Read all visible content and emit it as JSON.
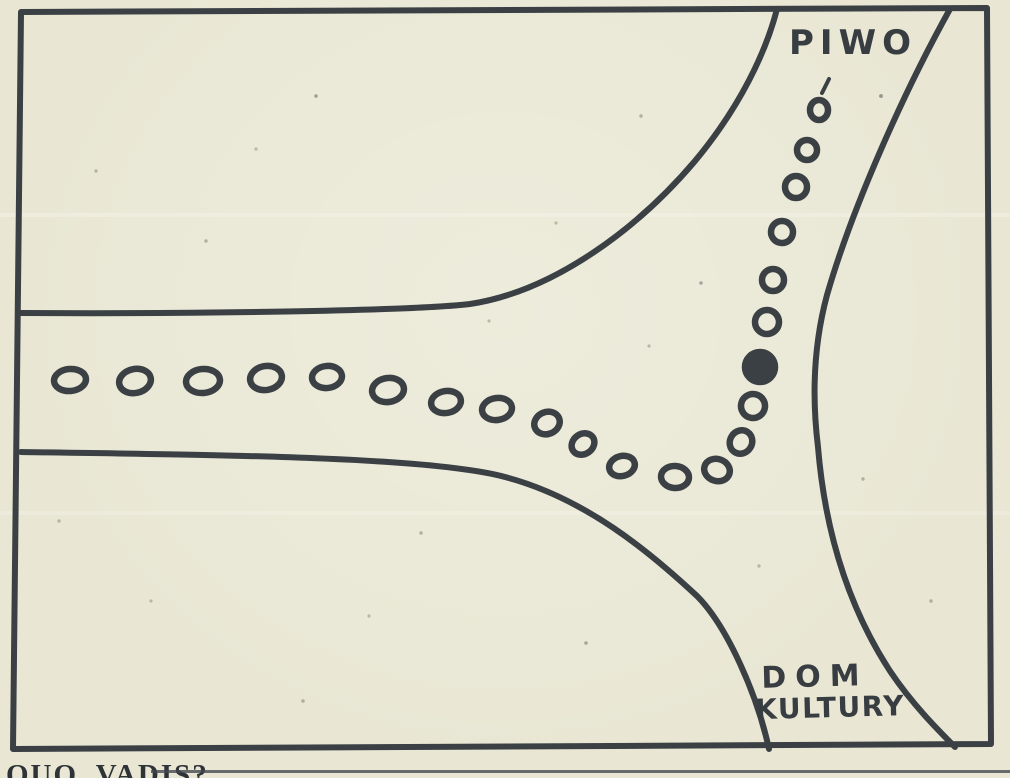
{
  "colors": {
    "paper": "#e9e7d4",
    "ink": "#3a4044"
  },
  "drawing": {
    "labels": {
      "piwo": "PIWO",
      "dom_line1": "DOM",
      "dom_line2": "KULTURY"
    },
    "roads": {
      "frame": "M 21 12 L 987 8 L 991 744 L 13 749 Z",
      "top_edge": "M 21 313 C 190 314 410 311 470 304 C 556 291 640 226 695 161 C 740 107 766 52 777 9",
      "bottom_edge": "M 21 452 C 230 455 430 457 505 477 C 585 498 650 552 697 596 C 727 626 757 694 769 749",
      "right_edge": "M 950 9 C 905 90 853 205 827 295 C 813 347 812 398 818 447 C 825 532 849 608 890 671 C 912 704 938 730 955 747"
    },
    "footprints": [
      {
        "cx": 70,
        "cy": 380,
        "rx": 16,
        "ry": 11,
        "rot": -5
      },
      {
        "cx": 135,
        "cy": 381,
        "rx": 16,
        "ry": 12,
        "rot": -12
      },
      {
        "cx": 203,
        "cy": 381,
        "rx": 17,
        "ry": 12,
        "rot": -5
      },
      {
        "cx": 266,
        "cy": 378,
        "rx": 16,
        "ry": 12,
        "rot": -10
      },
      {
        "cx": 327,
        "cy": 377,
        "rx": 15,
        "ry": 11,
        "rot": -6
      },
      {
        "cx": 388,
        "cy": 390,
        "rx": 16,
        "ry": 12,
        "rot": -8
      },
      {
        "cx": 446,
        "cy": 402,
        "rx": 15,
        "ry": 11,
        "rot": -10
      },
      {
        "cx": 497,
        "cy": 409,
        "rx": 15,
        "ry": 11,
        "rot": -8
      },
      {
        "cx": 547,
        "cy": 423,
        "rx": 13,
        "ry": 11,
        "rot": -22
      },
      {
        "cx": 583,
        "cy": 444,
        "rx": 12,
        "ry": 10,
        "rot": -35
      },
      {
        "cx": 622,
        "cy": 466,
        "rx": 13,
        "ry": 10,
        "rot": -15
      },
      {
        "cx": 675,
        "cy": 477,
        "rx": 14,
        "ry": 11,
        "rot": 4
      },
      {
        "cx": 717,
        "cy": 470,
        "rx": 13,
        "ry": 11,
        "rot": 18
      },
      {
        "cx": 741,
        "cy": 442,
        "rx": 11,
        "ry": 12,
        "rot": 32
      },
      {
        "cx": 753,
        "cy": 406,
        "rx": 12,
        "ry": 12,
        "rot": 10
      },
      {
        "cx": 760,
        "cy": 367,
        "rx": 15,
        "ry": 15,
        "rot": 0,
        "filled": true
      },
      {
        "cx": 767,
        "cy": 322,
        "rx": 12,
        "ry": 12,
        "rot": 0
      },
      {
        "cx": 773,
        "cy": 280,
        "rx": 11,
        "ry": 11,
        "rot": 0
      },
      {
        "cx": 782,
        "cy": 232,
        "rx": 11,
        "ry": 11,
        "rot": 6
      },
      {
        "cx": 796,
        "cy": 187,
        "rx": 11,
        "ry": 11,
        "rot": 0
      },
      {
        "cx": 807,
        "cy": 150,
        "rx": 10,
        "ry": 10,
        "rot": 0
      },
      {
        "cx": 819,
        "cy": 110,
        "rx": 9,
        "ry": 10,
        "rot": 0
      }
    ],
    "accent_tick": {
      "x1": 822,
      "y1": 93,
      "x2": 829,
      "y2": 79
    }
  },
  "caption": {
    "text": "QUO VADIS?"
  }
}
